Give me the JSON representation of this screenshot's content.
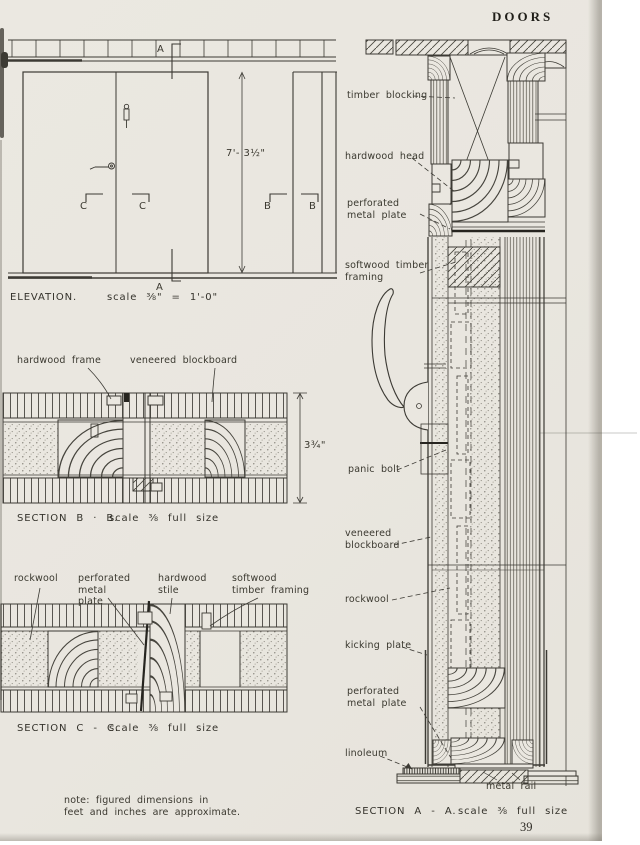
{
  "page": {
    "header": "DOORS",
    "page_number": "39",
    "note_line1": "note: figured dimensions in",
    "note_line2": "feet and inches are approximate."
  },
  "elevation": {
    "caption_title": "ELEVATION.",
    "caption_scale": "scale ⅜\" = 1'-0\"",
    "height_dimension": "7'- 3½\"",
    "marker_a_top": "A",
    "marker_a_bottom": "A",
    "marker_c_left": "C",
    "marker_c_right": "C",
    "marker_b_left": "B",
    "marker_b_right": "B"
  },
  "section_bb": {
    "caption_title": "SECTION B · B.",
    "caption_scale": "scale ⅜ full size",
    "thickness_dimension": "3¾\"",
    "label_hardwood_frame": "hardwood frame",
    "label_veneered_blockboard": "veneered blockboard"
  },
  "section_cc": {
    "caption_title": "SECTION C - C.",
    "caption_scale": "scale ⅜ full size",
    "label_rockwool": "rockwool",
    "label_perforated_metal_plate": "perforated metal plate",
    "label_hardwood_stile": "hardwood stile",
    "label_softwood_timber_framing": "softwood timber framing"
  },
  "section_aa": {
    "caption_title": "SECTION A - A.",
    "caption_scale": "scale ⅜ full size",
    "label_timber_blocking": "timber blocking",
    "label_hardwood_head": "hardwood head",
    "label_perforated_metal_plate_top": "perforated metal plate",
    "label_softwood_timber_framing": "softwood timber framing",
    "label_panic_bolt": "panic bolt",
    "label_veneered_blockboard": "veneered blockboard",
    "label_rockwool": "rockwool",
    "label_kicking_plate": "kicking plate",
    "label_perforated_metal_plate_bottom": "perforated metal plate",
    "label_linoleum": "linoleum",
    "label_metal_rail": "metal rail"
  },
  "colors": {
    "paper": "#eae7e0",
    "ink": "#3c3a34",
    "ink_dark": "#23211c"
  }
}
